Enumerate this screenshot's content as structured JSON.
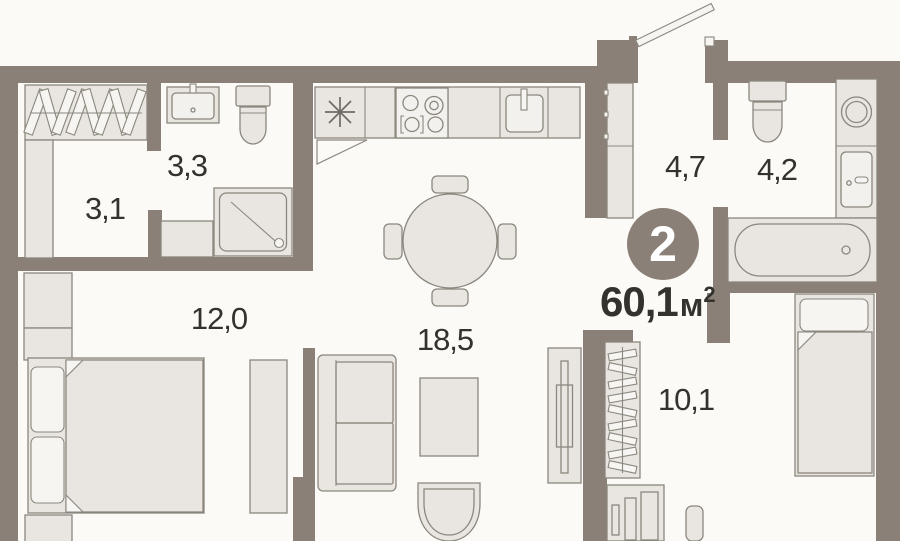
{
  "plan": {
    "badge": {
      "rooms_count": "2"
    },
    "total_area": {
      "value": "60,1",
      "unit": "м",
      "sup": "2"
    },
    "rooms": [
      {
        "name": "hallway",
        "area": "3,1"
      },
      {
        "name": "bathroom-small",
        "area": "3,3"
      },
      {
        "name": "bedroom-main",
        "area": "12,0"
      },
      {
        "name": "kitchen-living-room",
        "area": "18,5"
      },
      {
        "name": "entry-hall",
        "area": "4,7"
      },
      {
        "name": "bathroom-main",
        "area": "4,2"
      },
      {
        "name": "bedroom-second",
        "area": "10,1"
      }
    ],
    "colors": {
      "wall": "#8b8078",
      "furniture_fill": "#e9e6e1",
      "furniture_outline": "#8b877e",
      "background": "#fbfaf7",
      "text": "#34322e",
      "badge_background": "#8b8078",
      "badge_text": "#ffffff"
    }
  }
}
